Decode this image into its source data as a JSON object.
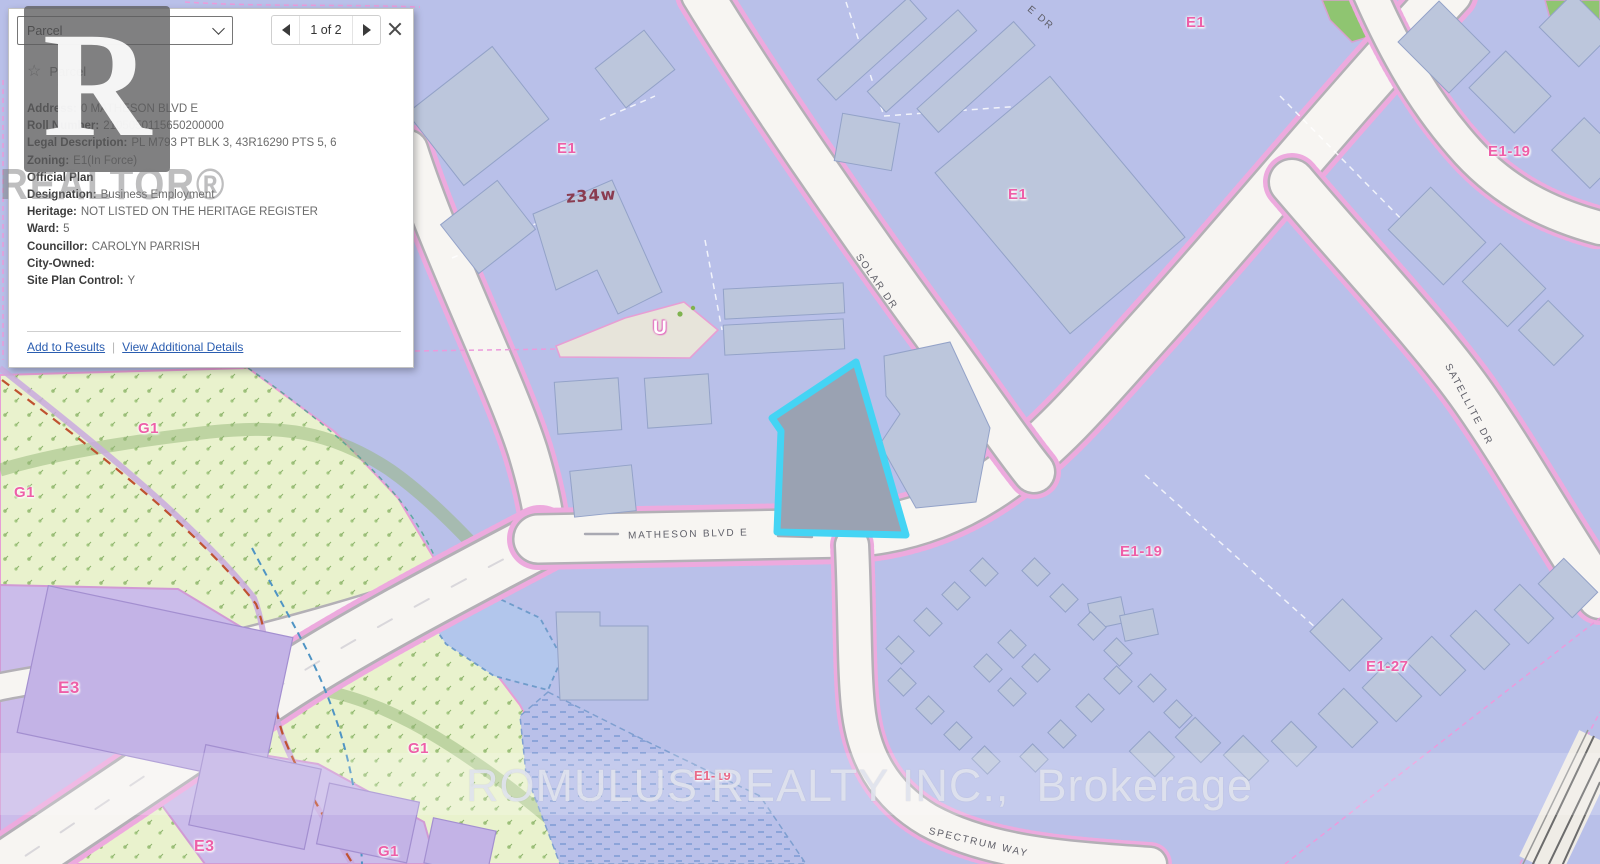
{
  "popup": {
    "selector": {
      "value": "Parcel"
    },
    "pager": {
      "label": "1 of 2"
    },
    "feature": {
      "star": "☆",
      "title": "Parcel"
    },
    "fields": [
      {
        "label": "Address:",
        "value": "0 MATHESON BLVD E"
      },
      {
        "label": "Roll Number:",
        "value": "2105050115650200000"
      },
      {
        "label": "Legal Description:",
        "value": "PL M793 PT BLK 3, 43R16290 PTS 5, 6"
      },
      {
        "label": "Zoning:",
        "value": "E1(In Force)"
      },
      {
        "label": "Official Plan",
        "value": ""
      },
      {
        "label": "Designation:",
        "value": "Business Employment"
      },
      {
        "label": "Heritage:",
        "value": "NOT LISTED ON THE HERITAGE REGISTER"
      },
      {
        "label": "Ward:",
        "value": "5"
      },
      {
        "label": "Councillor:",
        "value": "CAROLYN PARRISH"
      },
      {
        "label": "City-Owned:",
        "value": ""
      },
      {
        "label": "Site Plan Control:",
        "value": "Y"
      }
    ],
    "links": {
      "add": "Add to Results",
      "details": "View Additional Details"
    }
  },
  "map": {
    "zone_labels": [
      "E1",
      "E1",
      "E1",
      "E1-19",
      "E1-19",
      "E1-19",
      "E1-27",
      "G1",
      "G1",
      "G1",
      "G1",
      "E3",
      "E3"
    ],
    "road_labels": [
      "MATHESON BLVD E",
      "SOLAR DR",
      "SATELLITE DR",
      "SPECTRUM WAY",
      "E DR"
    ],
    "annotations": [
      "z34w",
      "U"
    ],
    "colors": {
      "background": "#b9c0e9",
      "building": "#bcc6dc",
      "greenspace": "#e9f2cd",
      "purple_zone": "#c6b7e8",
      "road": "#f7f5f2",
      "parcel_line": "#ec9bdc",
      "zone_label": "#ee5fa8",
      "selected_parcel_outline": "#44d4f4",
      "selected_parcel_fill": "#9aa2b2"
    }
  },
  "watermarks": {
    "logo_letter": "R",
    "logo_text": "REALTOR®",
    "banner": "ROMULUS REALTY INC.,  Brokerage"
  }
}
